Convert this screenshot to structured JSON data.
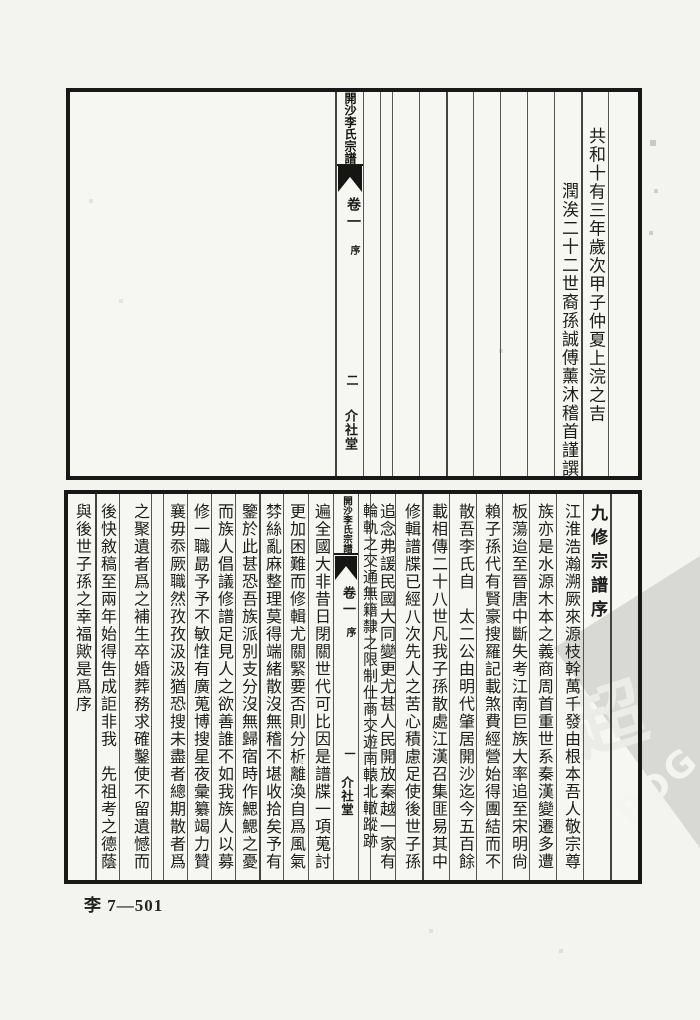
{
  "top_page": {
    "spine": {
      "title": "開沙李氏宗譜",
      "volume": "卷一",
      "section": "序",
      "page_number": "二",
      "hall": "介社堂"
    },
    "columns": [
      "共和十有三年歲次甲子仲夏上浣之吉",
      "潤涘二十二世裔孫誠傅薰沐稽首謹譔"
    ]
  },
  "bottom_page": {
    "spine": {
      "title": "開沙李氏宗譜",
      "volume": "卷一",
      "section": "序",
      "page_number": "一",
      "hall": "介社堂"
    },
    "right_columns": [
      "九修宗譜序",
      "江淮浩瀚溯厥來源枝幹萬千發由根本吾人敬宗尊",
      "族亦是水源木本之義商周首重世系秦漢變遷多遭",
      "板蕩迨至晉唐中斷失考江南巨族大率追至宋明尙",
      "賴子孫代有賢豪搜羅記載煞費經營始得團結而不",
      "散吾李氏自　太二公由明代肇居開沙迄今五百餘",
      "載相傳二十八世凡我子孫散處江漢召集匪易其中",
      "修輯譜牒已經八次先人之苦心積慮足使後世子孫",
      "追念弗諼民國大同變更尤甚人民開放秦越一家有",
      "輪軌之交通無籍隸之限制仕商交遊南轅北轍蹤跡"
    ],
    "left_columns": [
      "遍全國大非昔日閉關世代可比因是譜牒一項蒐討",
      "更加困難而修輯尤關緊要否則分析離渙自爲風氣",
      "棼絲亂麻整理莫得端緒散沒無稽不堪收拾矣予有",
      "鑒於此甚恐吾族派別支分沒無歸宿時作鰓鰓之憂",
      "而族人倡議修譜足見人之欲善誰不如我族人以募",
      "修一職勗予予不敏惟有廣蒐博搜星夜彙纂竭力贊",
      "襄毋忝厥職然孜孜汲汲猶恐搜未盡者總期散者爲",
      "之聚遺者爲之補生卒婚葬務求確鑿使不留遺憾而",
      "後快敘稿至兩年始得吿成詎非我　先祖考之德蔭",
      "與後世子孫之幸福歟是爲序"
    ]
  },
  "watermark": {
    "letters": "PDG",
    "seal_glyph": "超"
  },
  "footer": {
    "code": "李 7—501"
  }
}
